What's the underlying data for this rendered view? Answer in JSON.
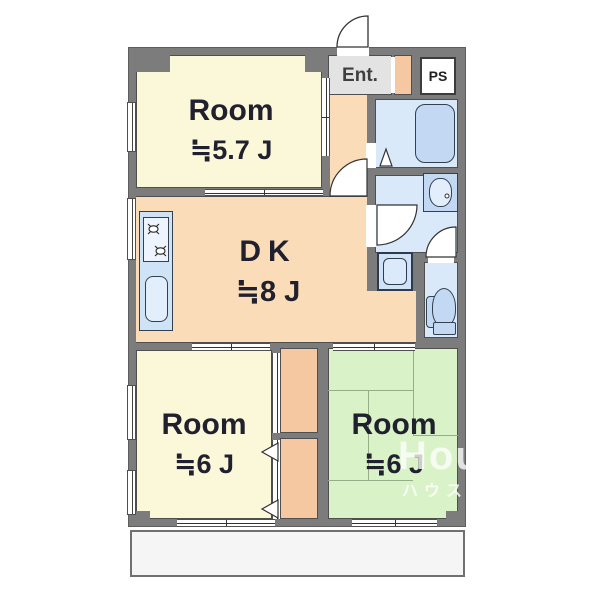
{
  "rooms": {
    "room57": {
      "name": "Room",
      "size": "≒5.7 J"
    },
    "dk": {
      "name": "DK",
      "size": "≒8 J"
    },
    "room6_left": {
      "name": "Room",
      "size": "≒6 J"
    },
    "room6_right": {
      "name": "Room",
      "size": "≒6 J"
    }
  },
  "labels": {
    "entrance": "Ent.",
    "pipe_space": "PS"
  },
  "watermark": {
    "en": "HouseStation",
    "jp": "ハウステーション"
  },
  "fixtures": [
    "bathtub",
    "washbasin",
    "toilet",
    "kitchen-sink",
    "gas-stove",
    "washing-machine-pan",
    "entrance-door-swing",
    "bath-folding-door",
    "washroom-door-swing",
    "toilet-door-swing",
    "sliding-door",
    "window",
    "balcony"
  ],
  "colors": {
    "wall": "#7c7c7c",
    "outline": "#4f4f4f",
    "cream": "#fbf8da",
    "dk_peach": "#fadcb9",
    "salmon": "#f6c8a2",
    "green": "#d9f2c7",
    "tatami_line": "#95ae88",
    "water_blue": "#d9e9fa",
    "fixture_blue": "#c2d8f3",
    "fixture_pale": "#e3eefc",
    "ent_gray": "#e3e3e3",
    "label": "#20202e",
    "balcony": "#f5f5f5"
  }
}
